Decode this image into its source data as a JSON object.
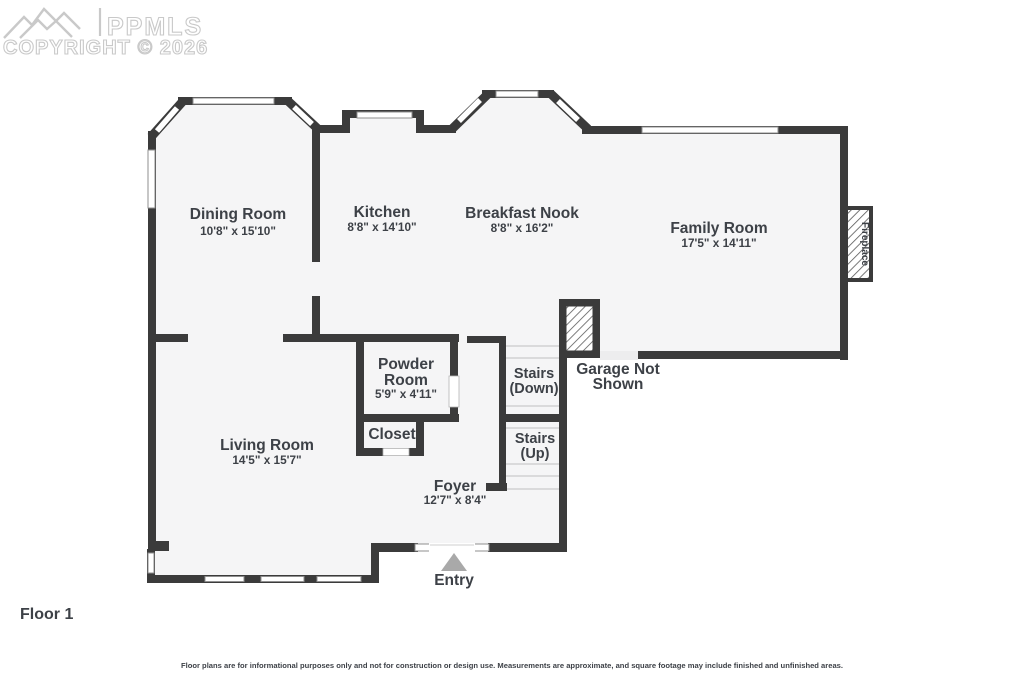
{
  "watermark": {
    "logo_text": "PPMLS",
    "copyright_text": "COPYRIGHT © 2026"
  },
  "floor_label": "Floor 1",
  "disclaimer": "Floor plans are for informational purposes only and not for construction or design use. Measurements are approximate, and square footage may include finished and unfinished areas.",
  "rooms": {
    "dining_room": {
      "name": "Dining Room",
      "dims": "10'8\" x 15'10\""
    },
    "kitchen": {
      "name": "Kitchen",
      "dims": "8'8\" x 14'10\""
    },
    "breakfast_nook": {
      "name": "Breakfast Nook",
      "dims": "8'8\" x 16'2\""
    },
    "family_room": {
      "name": "Family Room",
      "dims": "17'5\" x 14'11\""
    },
    "powder_room": {
      "name_line1": "Powder",
      "name_line2": "Room",
      "dims": "5'9\" x 4'11\""
    },
    "closet": {
      "name": "Closet"
    },
    "living_room": {
      "name": "Living Room",
      "dims": "14'5\" x 15'7\""
    },
    "foyer": {
      "name": "Foyer",
      "dims": "12'7\" x 8'4\""
    },
    "stairs_down": {
      "line1": "Stairs",
      "line2": "(Down)"
    },
    "stairs_up": {
      "line1": "Stairs",
      "line2": "(Up)"
    },
    "garage_note": {
      "line1": "Garage Not",
      "line2": "Shown"
    },
    "fireplace": {
      "name": "Fireplace"
    },
    "entry": {
      "name": "Entry"
    }
  },
  "colors": {
    "wall": "#3b3b3b",
    "floor": "#f5f5f6",
    "text": "#3d4147",
    "watermark": "#c9c9c9",
    "entry_arrow": "#a9a9a9",
    "window_frame": "#8f8f8f"
  }
}
